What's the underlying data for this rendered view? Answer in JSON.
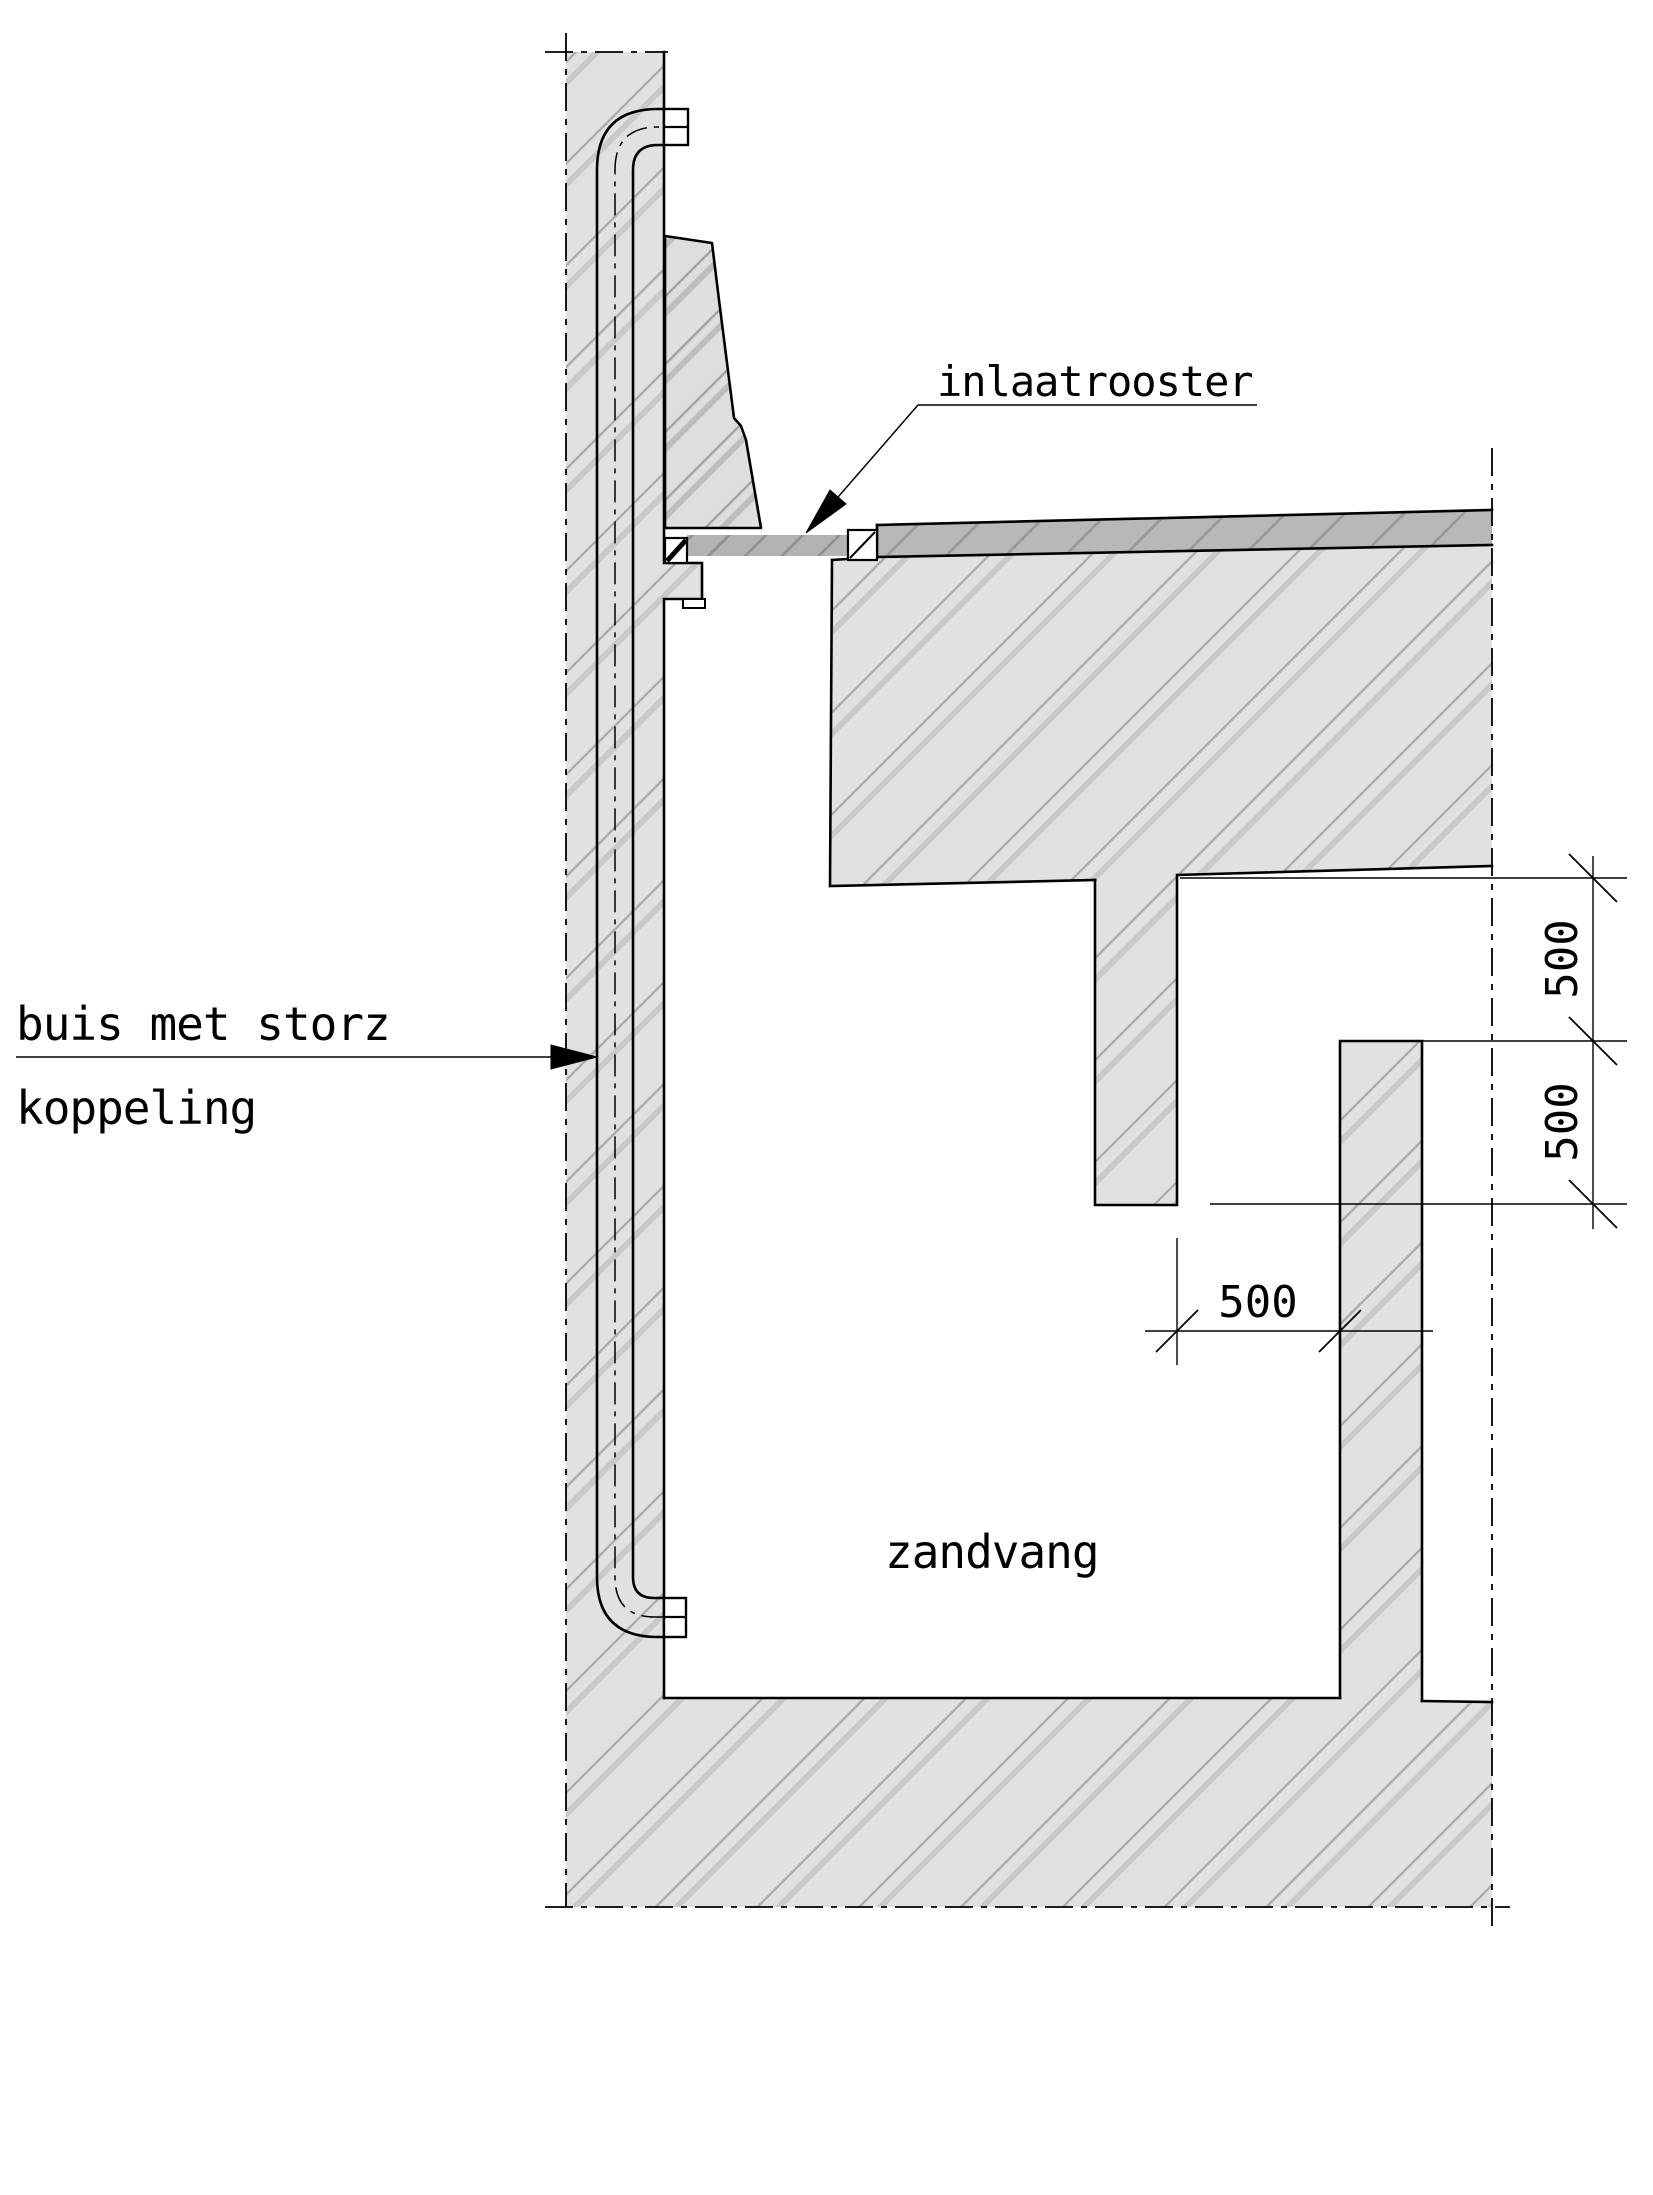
{
  "drawing": {
    "type": "technical-cross-section",
    "labels": {
      "inlet_grate": "inlaatrooster",
      "pipe_coupling_line1": "buis met storz",
      "pipe_coupling_line2": "koppeling",
      "sand_trap": "zandvang"
    },
    "dimensions": {
      "right_upper": "500",
      "right_lower": "500",
      "bottom_gap": "500"
    },
    "colors": {
      "background": "#ffffff",
      "concrete_fill": "#e1e1e1",
      "concrete_hatch": "#ababab",
      "street_fill": "#b8b8b8",
      "grate_fill": "#b3b3b3",
      "line": "#000000"
    }
  }
}
